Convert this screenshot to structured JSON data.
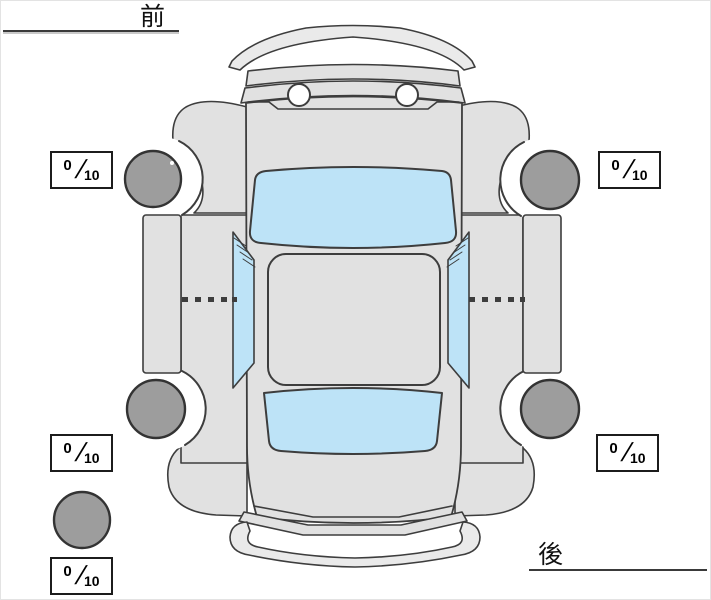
{
  "labels": {
    "front": "前",
    "rear": "後"
  },
  "tires": {
    "front_left": {
      "score": "0",
      "separator": "/",
      "max": "10"
    },
    "front_right": {
      "score": "0",
      "separator": "/",
      "max": "10"
    },
    "rear_left": {
      "score": "0",
      "separator": "/",
      "max": "10"
    },
    "rear_right": {
      "score": "0",
      "separator": "/",
      "max": "10"
    },
    "spare": {
      "score": "0",
      "separator": "/",
      "max": "10"
    }
  },
  "colors": {
    "body": "#e1e1e1",
    "bumper": "#eaeaea",
    "window": "#bde3f7",
    "wheel": "#9d9d9d",
    "wheel_outline": "#333333",
    "outline": "#3d3d3d",
    "arch": "#ffffff",
    "headlight": "#ffffff"
  }
}
